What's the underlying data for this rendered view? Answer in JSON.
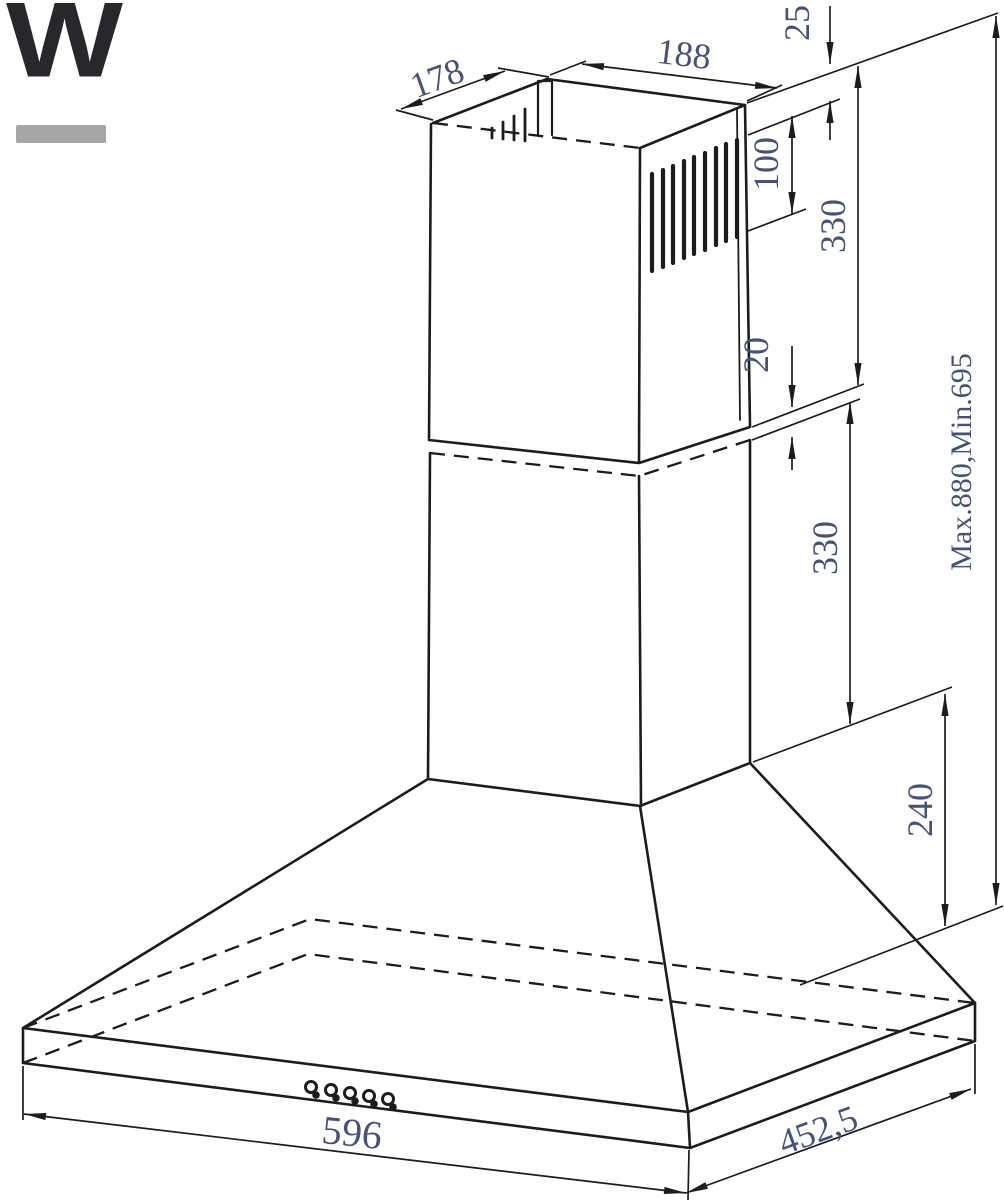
{
  "logo": {
    "letter": "W",
    "letter_color": "#28282c",
    "underline_color": "#a6a6a6"
  },
  "drawing": {
    "line_color": "#1c1c1c",
    "dim_text_color": "#46527a",
    "labels": {
      "duct_depth": "178",
      "duct_width": "188",
      "rim_to_vent_gap": "25",
      "vent_band_height": "100",
      "upper_chimney_section": "330",
      "telescopic_overlap": "20",
      "lower_chimney_section": "330",
      "overall_height_range": "Max.880,Min.695",
      "canopy_height": "240",
      "body_width": "596",
      "body_depth": "452,5"
    }
  }
}
